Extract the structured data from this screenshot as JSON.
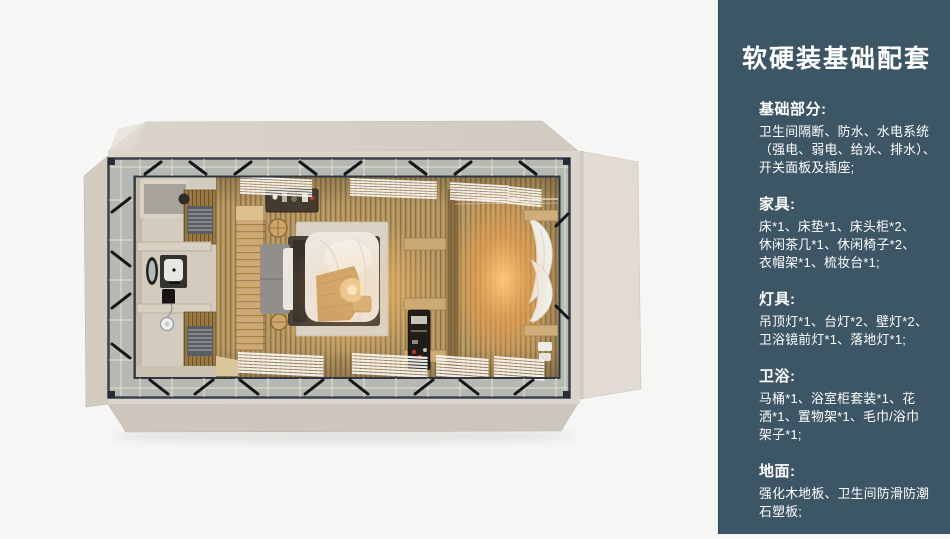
{
  "page": {
    "background": "#f6f6f5"
  },
  "panel": {
    "background": "#3d5666",
    "text_color": "#ffffff",
    "title": "软硬装基础配套",
    "sections": [
      {
        "heading": "基础部分:",
        "lines": [
          "卫生间隔断、防水、水电系统",
          "（强电、弱电、给水、排水）、",
          "开关面板及插座;"
        ]
      },
      {
        "heading": "家具:",
        "lines": [
          "床*1、床垫*1、床头柜*2、",
          "休闲茶几*1、休闲椅子*2、",
          "衣帽架*1、梳妆台*1;"
        ]
      },
      {
        "heading": "灯具:",
        "lines": [
          "吊顶灯*1、台灯*2、壁灯*2、",
          "卫浴镜前灯*1、落地灯*1;"
        ]
      },
      {
        "heading": "卫浴:",
        "lines": [
          "马桶*1、浴室柜套装*1、花",
          "洒*1、置物架*1、毛巾/浴巾",
          "架子*1;"
        ]
      },
      {
        "heading": "地面:",
        "lines": [
          "强化木地板、卫生间防滑防潮",
          "石塑板;"
        ]
      }
    ]
  },
  "render_colors": {
    "shell_beige": "#dbd5cb",
    "steel_frame": "#3a414d",
    "floor_wood": "#b2945f",
    "warm_glow": "#f2b960",
    "bathroom_wall": "#d3ccbe"
  }
}
